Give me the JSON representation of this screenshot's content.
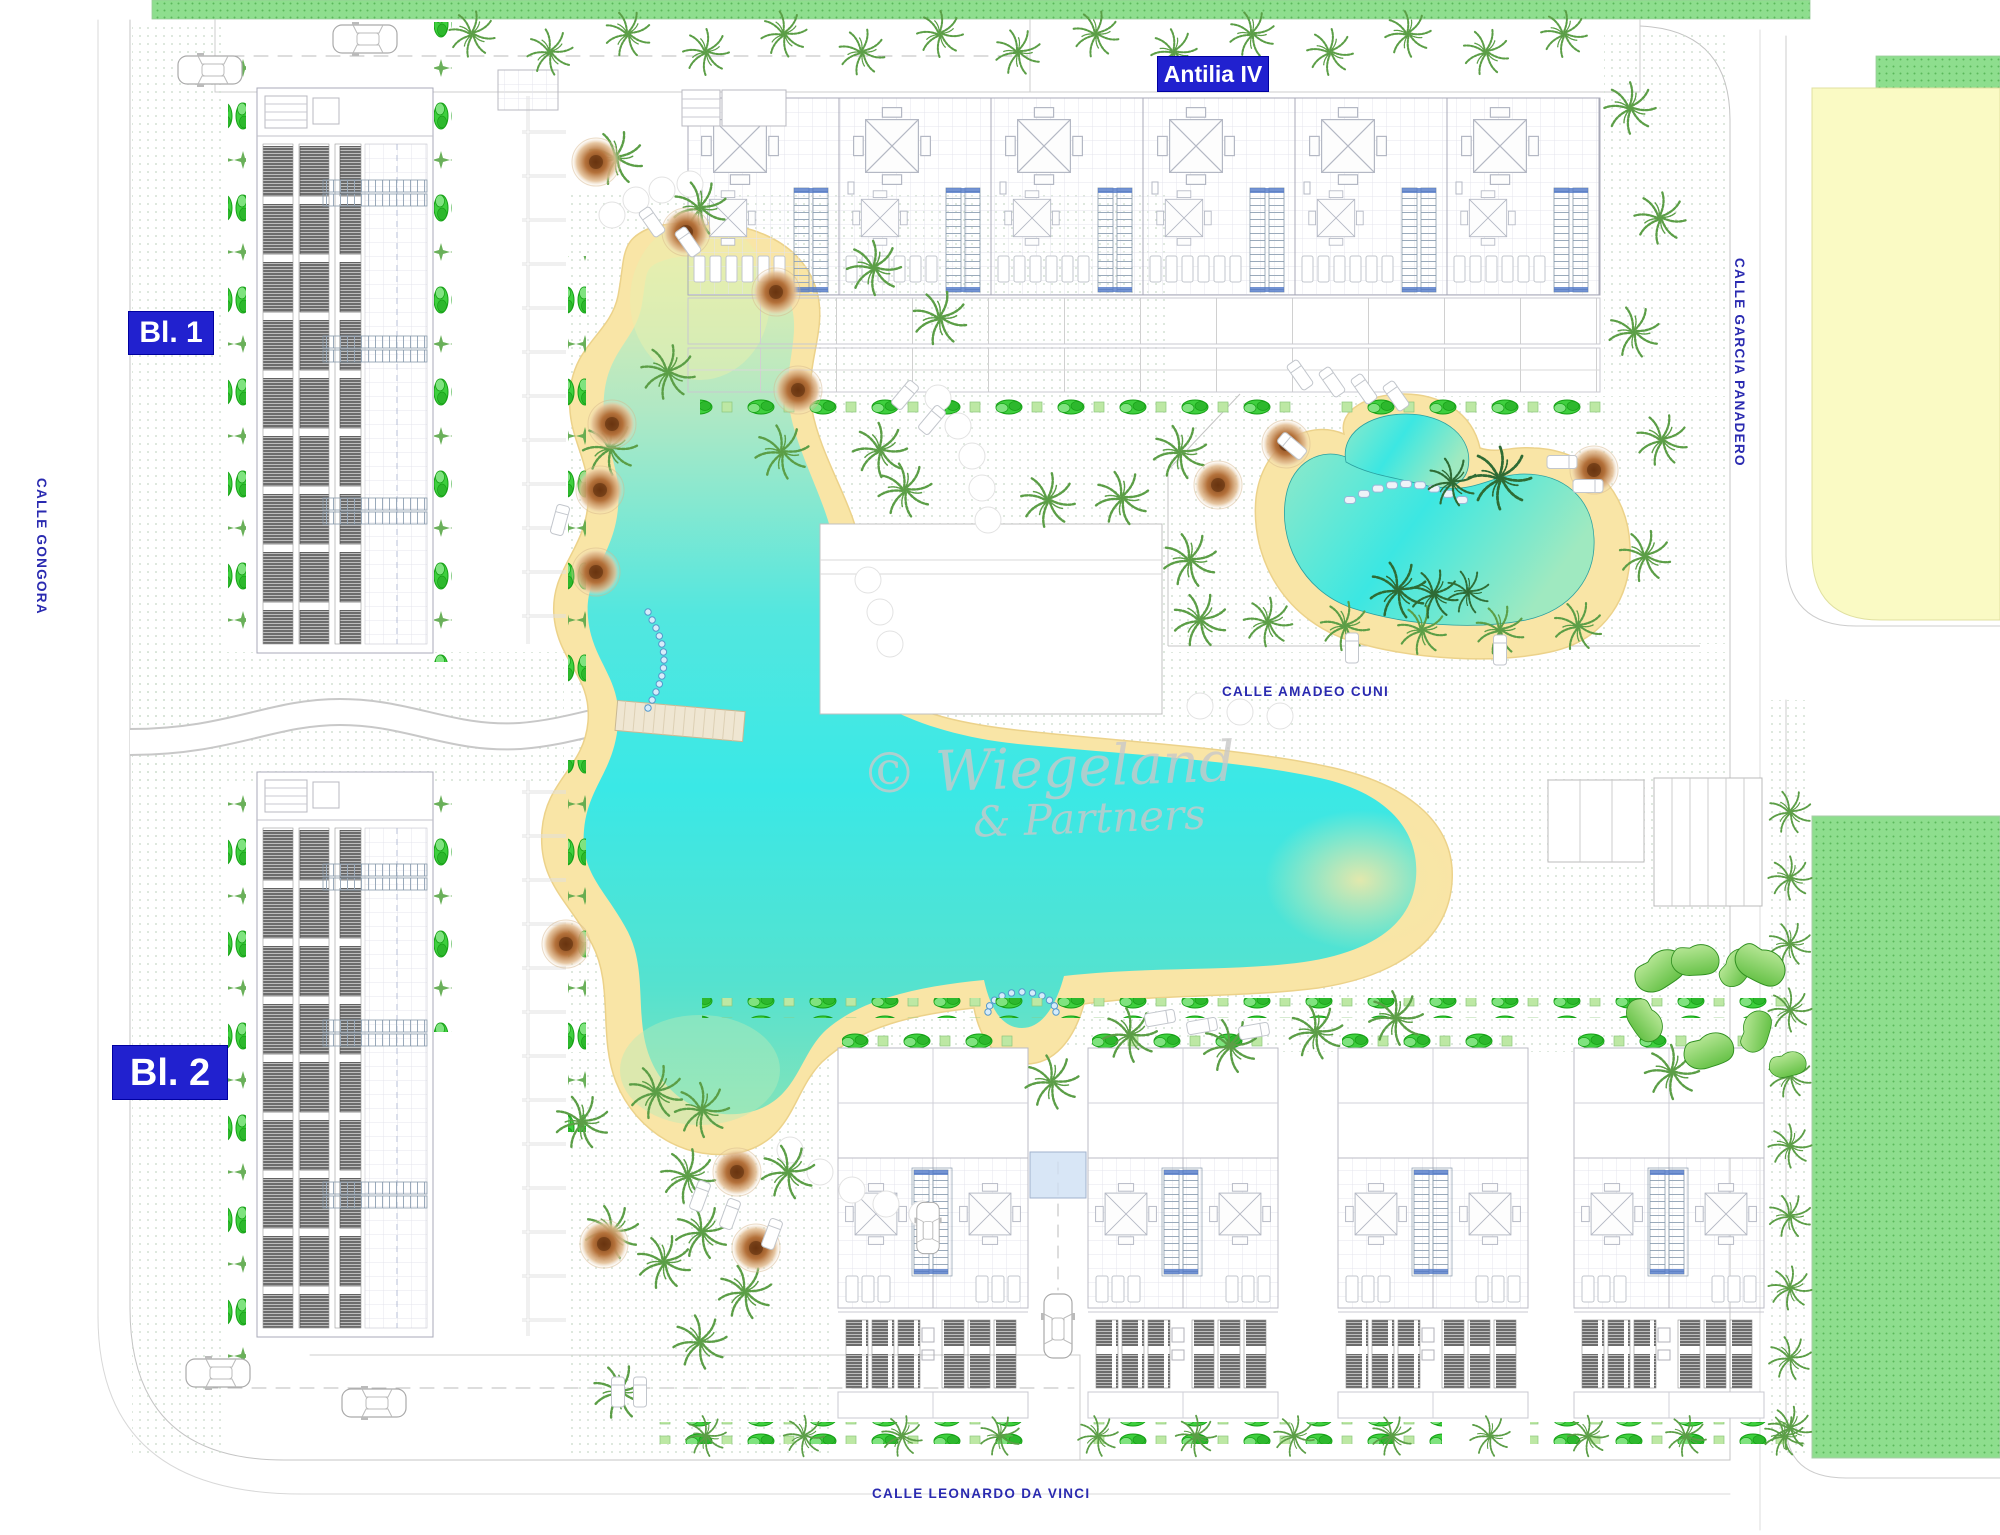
{
  "page": {
    "type": "architectural-site-plan",
    "project_name": "Antilia IV"
  },
  "labels": {
    "project": "Antilia IV",
    "block_1": "Bl. 1",
    "block_2": "Bl. 2"
  },
  "streets": {
    "west": "CALLE GONGORA",
    "east": "CALLE GARCIA PANADERO",
    "inner": "CALLE AMADEO CUNI",
    "south": "CALLE LEONARDO DA VINCI"
  },
  "watermark": {
    "line1": "© Wiegeland",
    "line2": "& Partners"
  },
  "colors": {
    "label_bg": "#2121cf",
    "label_text": "#ffffff",
    "street_text": "#2a2ab0",
    "water_turquoise": "#3ae8e4",
    "water_edge_green": "#bfe9ae",
    "sand": "#f9e5a6",
    "sand_deep": "#f2cf7e",
    "grass_green": "#8ede8e",
    "pale_yellow_lot": "#fafac4",
    "palm_green": "#5b9e46",
    "palm_dark_green": "#2e6b34",
    "bush_green": "#2ec82e",
    "solar_panel_gray": "#6a6a6a",
    "drawing_line_gray": "#c8c8c8",
    "tree_brown": "#9c5a28",
    "watermark_gray": "#c9c9c9"
  },
  "icons": {
    "palm-tree-icon": "radial frond star",
    "shade-tree-icon": "brown circular canopy",
    "bush-icon": "green shrub cluster",
    "sun-lounger-icon": "white lounger rectangle",
    "dining-table-icon": "square table with X and four chairs",
    "staircase-icon": "double ladder run",
    "car-icon": "car outline",
    "stepping-stones-icon": "dotted water crossing",
    "solar-panel-icon": "hatched dark panel strip"
  }
}
